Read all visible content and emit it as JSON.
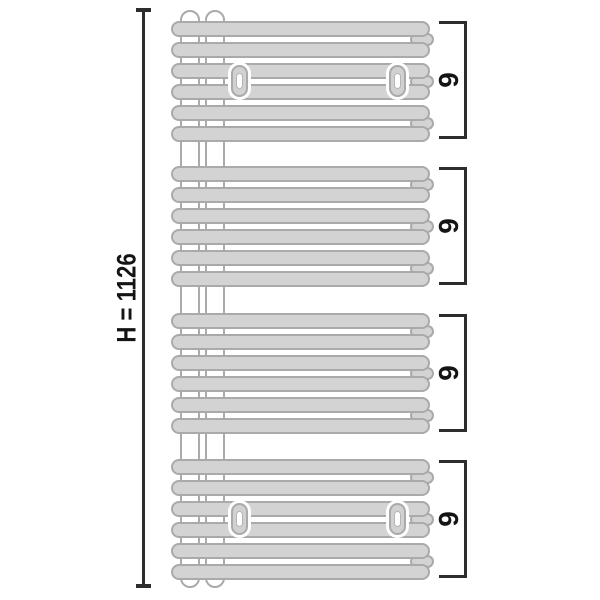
{
  "dimension": {
    "label": "H = 1126"
  },
  "radiator": {
    "collector_pipes": 2,
    "groups": [
      {
        "count_label": "6",
        "tube_count": 6,
        "tube_pairs": 3,
        "has_wall_brackets": true
      },
      {
        "count_label": "6",
        "tube_count": 6,
        "tube_pairs": 3,
        "has_wall_brackets": false
      },
      {
        "count_label": "6",
        "tube_count": 6,
        "tube_pairs": 3,
        "has_wall_brackets": false
      },
      {
        "count_label": "6",
        "tube_count": 6,
        "tube_pairs": 3,
        "has_wall_brackets": true
      }
    ],
    "wall_brackets_per_group": 2
  },
  "colors": {
    "tube_fill": "#d2d3d2",
    "tube_outline": "#a9aaa9",
    "line": "#2d2d2d",
    "text": "#141414",
    "background": "#ffffff"
  }
}
